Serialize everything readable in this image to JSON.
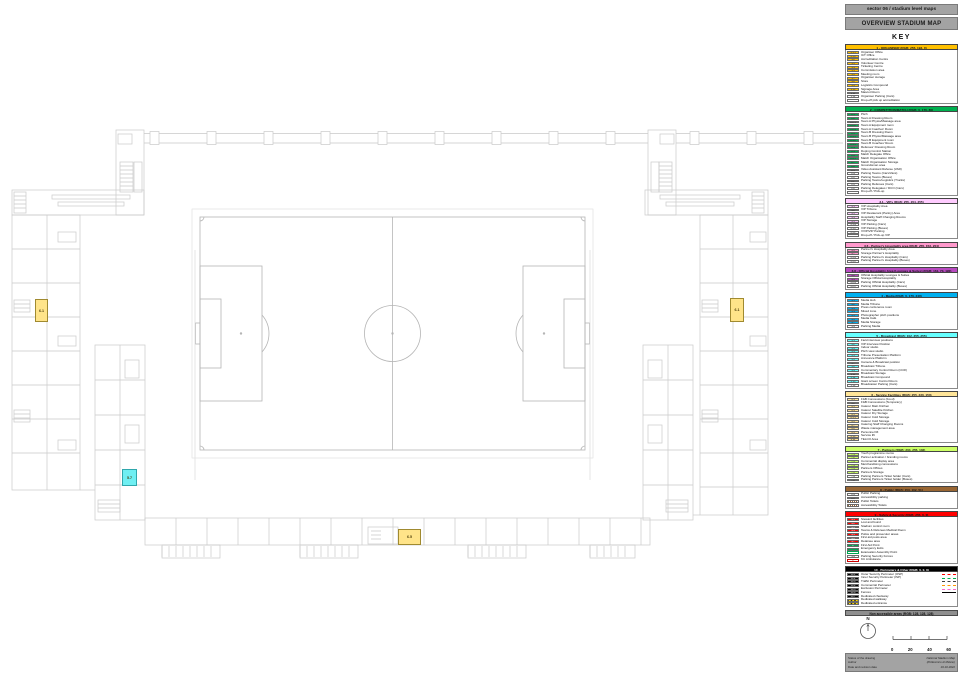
{
  "header": {
    "line1": "sector 06 / stadium level maps",
    "line2": "OVERVIEW STADIUM MAP",
    "key_title": "KEY"
  },
  "legend": {
    "sections": [
      {
        "id": "1",
        "title": "1 - ORGANISER (RGB: 255, 192, 0)",
        "color": "#FFC000",
        "chip_text": "#222222",
        "items": [
          {
            "code": "1.1.1",
            "label": "Organiser Office"
          },
          {
            "code": "1.1.2",
            "label": "ICT Office"
          },
          {
            "code": "1.2",
            "label": "Accreditation Centre"
          },
          {
            "code": "1.3",
            "label": "Volunteer Centre"
          },
          {
            "code": "1.4",
            "label": "Ticketing Centre"
          },
          {
            "code": "1.5",
            "label": "Commission area"
          },
          {
            "code": "1.6",
            "label": "Meeting room"
          },
          {
            "code": "1.7",
            "label": "Organiser storage"
          },
          {
            "code": "1.8",
            "label": "Store"
          },
          {
            "code": "1.9",
            "label": "Logistics Compound"
          },
          {
            "code": "1.10",
            "label": "Signage Area"
          },
          {
            "code": "1.11",
            "label": "Mascot Room"
          },
          {
            "code": "1.12",
            "label": "Organiser Parking (Cars)",
            "chip": "white"
          },
          {
            "code": "",
            "label": "Drop-off pick up accreditation",
            "chip": "white"
          }
        ]
      },
      {
        "id": "2",
        "title": "2 - COMPETITION/MATCH (RGB: 0, 176, 80)",
        "color": "#00B050",
        "chip_text": "#222222",
        "items": [
          {
            "code": "2.1",
            "label": "Pitch"
          },
          {
            "code": "2.2",
            "label": "Team A Dressing Room"
          },
          {
            "code": "2.2.1",
            "label": "Team A Physio/Massage area"
          },
          {
            "code": "2.2.2",
            "label": "Team A Equipment room"
          },
          {
            "code": "2.2.3",
            "label": "Team A Coaches' Room"
          },
          {
            "code": "2.3",
            "label": "Team B Dressing Room"
          },
          {
            "code": "2.3.1",
            "label": "Team B Physio/Massage area"
          },
          {
            "code": "2.3.2",
            "label": "Team B Equipment room"
          },
          {
            "code": "2.3.3",
            "label": "Team B Coaches' Room"
          },
          {
            "code": "2.4",
            "label": "Referees' Dressing Room"
          },
          {
            "code": "2.5",
            "label": "Doping Control Station"
          },
          {
            "code": "2.6",
            "label": "Match Delegate Office"
          },
          {
            "code": "2.6.1",
            "label": "Match Organisation Office"
          },
          {
            "code": "2.7",
            "label": "Match Organisation Storage"
          },
          {
            "code": "2.8",
            "label": "Groundsman area"
          },
          {
            "code": "2.9",
            "label": "Video Assistant Referee (VAR)"
          },
          {
            "code": "2.a",
            "label": "Parking Teams (Cars/Vans)",
            "chip": "white"
          },
          {
            "code": "2.b",
            "label": "Parking Teams (Buses)",
            "chip": "white"
          },
          {
            "code": "2.c",
            "label": "Parking Teams/Logistics (Trucks)",
            "chip": "white"
          },
          {
            "code": "2.d",
            "label": "Parking Referees (Cars)",
            "chip": "white"
          },
          {
            "code": "2.e",
            "label": "Parking Delegates / DCO (Cars)",
            "chip": "white"
          },
          {
            "code": "",
            "label": "Drop-off / Pick-up",
            "chip": "white"
          }
        ]
      },
      {
        "id": "3.1",
        "title": "3.1 - VIPs (RGB: 255, 204, 255)",
        "color": "#FFCCFF",
        "chip_text": "#222222",
        "items": [
          {
            "code": "3.1",
            "label": "VIP Hospitality Area"
          },
          {
            "code": "3.2",
            "label": "VIP Tribune"
          },
          {
            "code": "3.3",
            "label": "VIP Restaurant (Pantry) Area"
          },
          {
            "code": "3.4",
            "label": "Hospitality Staff Changing Rooms"
          },
          {
            "code": "3.5",
            "label": "VIP Storage"
          },
          {
            "code": "3.1.a",
            "label": "VIP Parking (Cars)",
            "chip": "white"
          },
          {
            "code": "3.1.b",
            "label": "VIP Parking (Buses)",
            "chip": "white"
          },
          {
            "code": "3.1.c",
            "label": "VVIP/VIP Parking",
            "chip": "white"
          },
          {
            "code": "",
            "label": "Drop-off / Pick-up VIP",
            "chip": "white"
          }
        ]
      },
      {
        "id": "3.6",
        "title": "3.6 - Partner's Hospitality area (RGB: 255, 153, 204)",
        "color": "#FF99CC",
        "chip_text": "#222222",
        "items": [
          {
            "code": "3.6",
            "label": "Partner's Hospitality Area"
          },
          {
            "code": "3.7",
            "label": "Storage Partner's Hospitality"
          },
          {
            "code": "3.6.a",
            "label": "Parking Partner's Hospitality (Cars)",
            "chip": "white"
          },
          {
            "code": "3.6.b",
            "label": "Parking Partner's Hospitality (Buses)",
            "chip": "white"
          }
        ]
      },
      {
        "id": "3.8",
        "title": "3.8 - Official Hospitality Area (Lounges & Suites) (RGB: 161, 73, 190)",
        "color": "#B84AC0",
        "chip_text": "#222222",
        "items": [
          {
            "code": "3.8",
            "label": "Official Hospitality Lounges & Suites"
          },
          {
            "code": "3.9",
            "label": "Storage Official Hospitality"
          },
          {
            "code": "3.8.a",
            "label": "Parking Official Hospitality (Cars)",
            "chip": "white"
          },
          {
            "code": "3.8.b",
            "label": "Parking Official Hospitality (Buses)",
            "chip": "white"
          }
        ]
      },
      {
        "id": "4",
        "title": "4 - Media (RGB: 0, 176, 240)",
        "color": "#00B0F0",
        "chip_text": "#222222",
        "items": [
          {
            "code": "4.1",
            "label": "Media Hub"
          },
          {
            "code": "4.2",
            "label": "Media Tribune"
          },
          {
            "code": "4.3",
            "label": "Press conference room"
          },
          {
            "code": "4.4",
            "label": "Mixed zone"
          },
          {
            "code": "4.5",
            "label": "Photographer pitch positions"
          },
          {
            "code": "4.6",
            "label": "Media Café"
          },
          {
            "code": "4.7",
            "label": "Media Storage"
          },
          {
            "code": "4.a",
            "label": "Parking Media",
            "chip": "white"
          }
        ]
      },
      {
        "id": "5",
        "title": "5 - Broadcast (RGB: 102, 255, 255)",
        "color": "#66FFFF",
        "chip_text": "#222222",
        "items": [
          {
            "code": "5.1",
            "label": "Field interview positions"
          },
          {
            "code": "5.2",
            "label": "VIP Interview Position"
          },
          {
            "code": "5.3",
            "label": "Indoor studio"
          },
          {
            "code": "5.4",
            "label": "Pitch view studio"
          },
          {
            "code": "5.5",
            "label": "Tribune Presentation Platform"
          },
          {
            "code": "5.6",
            "label": "Announce Platform"
          },
          {
            "code": "5.7",
            "label": "Camera & Broadcast position"
          },
          {
            "code": "5.8",
            "label": "Broadcast Tribune"
          },
          {
            "code": "5.9",
            "label": "Commentary Control Room (CCR)"
          },
          {
            "code": "5.11",
            "label": "Broadcast Storage"
          },
          {
            "code": "5.12",
            "label": "Broadcast Compound"
          },
          {
            "code": "5.13",
            "label": "Giant screen Control Room"
          },
          {
            "code": "5.14",
            "label": "Broadcaster Parking (Cars)",
            "chip": "white"
          }
        ]
      },
      {
        "id": "6",
        "title": "6 - Service Facilities (RGB: 255, 230, 153)",
        "color": "#FFE599",
        "chip_text": "#222222",
        "items": [
          {
            "code": "6.1",
            "label": "F&B Concessions (Food)"
          },
          {
            "code": "6.2",
            "label": "F&B Concessions (Temporary)"
          },
          {
            "code": "6.3",
            "label": "Caterer Main Kitchen"
          },
          {
            "code": "6.4",
            "label": "Caterer Satellite Kitchen"
          },
          {
            "code": "6.5",
            "label": "Caterer Dry Storage"
          },
          {
            "code": "6.5.1",
            "label": "Caterer Cold Storage"
          },
          {
            "code": "6.6",
            "label": "Caterer Cold Storage"
          },
          {
            "code": "6.7",
            "label": "Catering Staff Changing Rooms"
          },
          {
            "code": "6.8",
            "label": "Waste management area"
          },
          {
            "code": "6.9",
            "label": "Personnel lift"
          },
          {
            "code": "6.10",
            "label": "Service lift"
          },
          {
            "code": "6.11",
            "label": "TELCO Area"
          }
        ]
      },
      {
        "id": "7",
        "title": "7 - Partners (RGB: 204, 255, 102)",
        "color": "#CCFF66",
        "chip_text": "#222222",
        "items": [
          {
            "code": "7.1",
            "label": "Youth programme rooms"
          },
          {
            "code": "7.2",
            "label": "Partner activation / branding rooms"
          },
          {
            "code": "7.3",
            "label": "Commercial display area"
          },
          {
            "code": "7.4",
            "label": "Merchandising concessions"
          },
          {
            "code": "7.5",
            "label": "Partners Offices"
          },
          {
            "code": "7.6",
            "label": "Partners Storage"
          },
          {
            "code": "7.a",
            "label": "Parking Partners Ticket holder (Cars)",
            "chip": "white"
          },
          {
            "code": "7.b",
            "label": "Parking Partners Ticket holder (Buses)",
            "chip": "white"
          }
        ]
      },
      {
        "id": "8",
        "title": "8 - Public (RGB: 153, 102, 51)",
        "color": "#996633",
        "chip_text": "#ffffff",
        "items": [
          {
            "code": "8.a",
            "label": "Public Parking",
            "chip": "white"
          },
          {
            "code": "8.b",
            "label": "Accessibility parking",
            "chip": "white"
          },
          {
            "code": "",
            "label": "Public Toilets",
            "icon": "toilet-icon"
          },
          {
            "code": "",
            "label": "Accessibility Toilets",
            "icon": "accessible-toilet-icon"
          }
        ]
      },
      {
        "id": "9",
        "title": "9 - Safety & Security (RGB: 255, 0, 0)",
        "color": "#FF0000",
        "chip_text": "#ffffff",
        "items": [
          {
            "code": "9.1",
            "label": "Steward facilities"
          },
          {
            "code": "9.2",
            "label": "Lost and found"
          },
          {
            "code": "9.3",
            "label": "Stadium control room"
          },
          {
            "code": "9.4",
            "label": "Teams & Referees Medical Room"
          },
          {
            "code": "9.5",
            "label": "Police and prosecutor areas"
          },
          {
            "code": "9.6",
            "label": "First aid posts area"
          },
          {
            "code": "9.7",
            "label": "Detainee area"
          },
          {
            "code": "+",
            "label": "First Aid Point",
            "icon": "first-aid-icon"
          },
          {
            "code": "",
            "label": "Emergency Exits",
            "icon": "exit-icon"
          },
          {
            "code": "",
            "label": "Evacuation Assembly Point",
            "icon": "assembly-icon"
          },
          {
            "code": "9.a",
            "label": "Parking Security Forces",
            "chip": "white"
          },
          {
            "code": "+",
            "label": "9.b Ambulance",
            "icon": "ambulance-icon"
          }
        ]
      },
      {
        "id": "10",
        "title": "10 - Perimeters & Other (RGB: 0, 0, 0)",
        "color": "#000000",
        "title_text": "#ffffff",
        "chip_text": "#ffffff",
        "items": [
          {
            "code": "10.1",
            "label": "Outer Security Perimeter (OSP)",
            "line": "#FF0000"
          },
          {
            "code": "10.2",
            "label": "Inner Security Perimeter (ISP)",
            "line": "#00B050"
          },
          {
            "code": "10.3",
            "label": "Traffic Perimeter",
            "line": "#404040"
          },
          {
            "code": "10.4",
            "label": "Commercial Perimeter",
            "line": "#FF9900"
          },
          {
            "code": "10.5",
            "label": "Exclusion Perimeter",
            "line": "#FF66CC"
          },
          {
            "code": "10.6",
            "label": "Fences",
            "line": "#000000",
            "line_solid": true
          },
          {
            "code": "10.7",
            "label": "Dedicated checkway"
          },
          {
            "code": "",
            "label": "Dedicated walkway",
            "icon": "stripes-icon"
          },
          {
            "code": "",
            "label": "Dedicated entrance",
            "icon": "stripes-icon"
          }
        ]
      }
    ]
  },
  "non_accessible": {
    "label": "Non accessible areas (RGB: 128, 128, 128)",
    "color": "#808080"
  },
  "compass": {
    "label": "N"
  },
  "scale_bar": {
    "ticks": [
      "0",
      "20",
      "40",
      "60"
    ]
  },
  "footer": {
    "left": [
      "Status of the drawing",
      "Author",
      "Date and revision date"
    ],
    "right": [
      "National Stadium Map",
      "(Politecnico di Milano)",
      "19.10.2022"
    ]
  },
  "plan": {
    "markers": [
      {
        "code": "6.1",
        "x": 35,
        "y": 299,
        "w": 13,
        "h": 23,
        "bg": "#FFE489",
        "border": "#A08A30"
      },
      {
        "code": "6.1",
        "x": 730,
        "y": 298,
        "w": 14,
        "h": 24,
        "bg": "#FFE489",
        "border": "#A08A30"
      },
      {
        "code": "5.7",
        "x": 122,
        "y": 469,
        "w": 15,
        "h": 17,
        "bg": "#6FEFF2",
        "border": "#2FA7AC"
      },
      {
        "code": "6.5",
        "x": 398,
        "y": 529,
        "w": 23,
        "h": 16,
        "bg": "#FFE489",
        "border": "#A08A30"
      }
    ]
  }
}
